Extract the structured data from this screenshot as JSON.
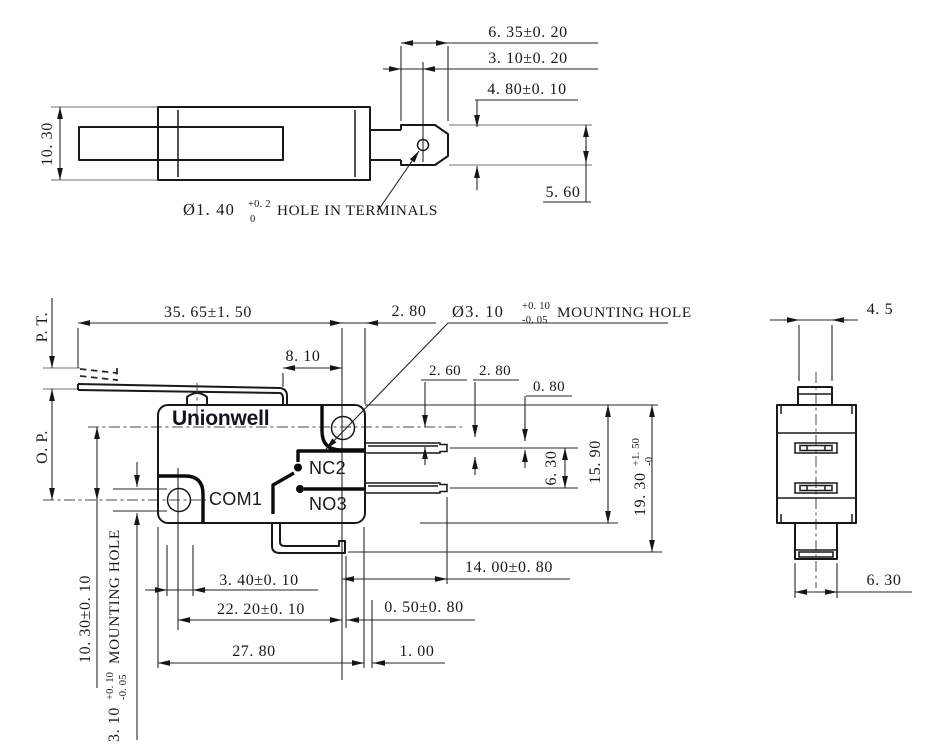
{
  "colors": {
    "object_line": "#191919",
    "dimension_line": "#262626",
    "extension_line": "#8d8d8d",
    "brand_text": "#10151c"
  },
  "top_view": {
    "dims": {
      "height": "10. 30",
      "terminal_total": "6. 35±0. 20",
      "hole_offset": "3. 10±0. 20",
      "terminal_width": "4. 80±0. 10",
      "terminal_height": "5. 60"
    },
    "hole_note": {
      "base": "Ø1. 40",
      "tol_sup": "+0. 2",
      "tol_sub": "0",
      "label": "HOLE IN TERMINALS"
    }
  },
  "front_view": {
    "brand": "Unionwell",
    "terminal_labels": {
      "com": "COM1",
      "nc": "NC2",
      "no": "NO3"
    },
    "mounting_hole_note": {
      "base": "Ø3. 10",
      "tol_sup": "+0. 10",
      "tol_sub": "-0. 05",
      "label": "MOUNTING HOLE"
    },
    "left_hole_note": {
      "base": "3. 10",
      "tol_sup": "+0. 10",
      "tol_sub": "-0. 05",
      "label": "MOUNTING HOLE"
    },
    "dims": {
      "pre_travel": "P. T.",
      "operating_position": "O. P.",
      "lever_length": "35. 65±1. 50",
      "hole_to_edge": "2. 80",
      "lever_bend": "8. 10",
      "hole_cl_offset": "2. 60",
      "blade_offset": "2. 80",
      "blade_step": "0. 80",
      "blade_pitch": "6. 30",
      "body_height": "15. 90",
      "overall_height": {
        "base": "19. 30",
        "tol_sup": "+1. 50",
        "tol_sub": "-0"
      },
      "hole_vertical": "10. 30±0. 10",
      "terminal_end": "3. 40±0. 10",
      "hole_pitch": "22. 20±0. 10",
      "body_width": "27. 80",
      "terminal_length": "14. 00±0. 80",
      "terminal_offset": "0. 50±0. 80",
      "edge_step": "1. 00"
    }
  },
  "side_view": {
    "dims": {
      "plunger_width": "4. 5",
      "terminal_width": "6. 30"
    }
  }
}
